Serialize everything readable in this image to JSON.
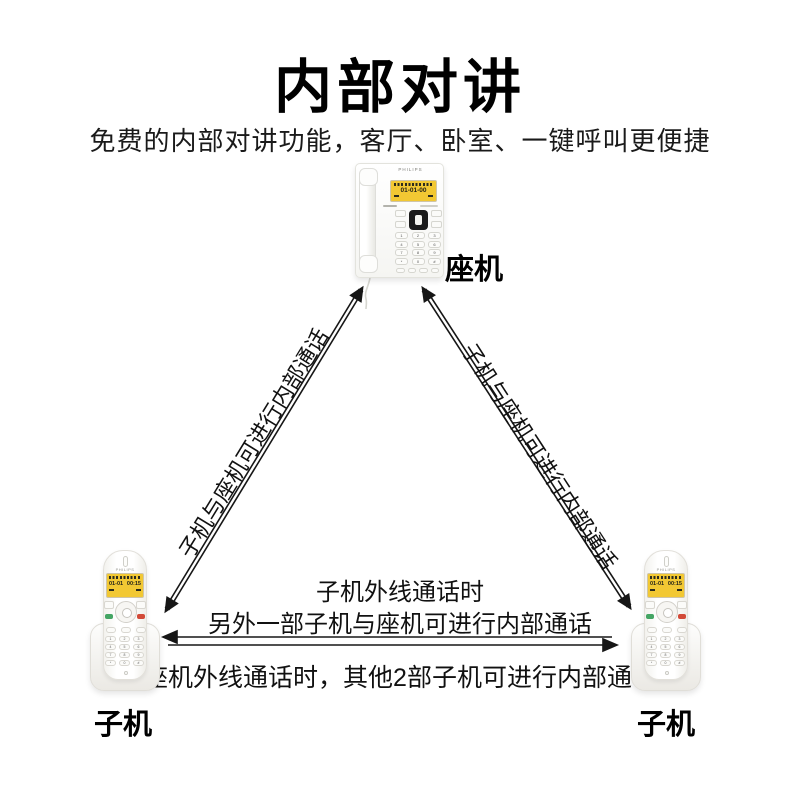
{
  "page": {
    "title": "内部对讲",
    "subtitle": "免费的内部对讲功能，客厅、卧室、一键呼叫更便捷"
  },
  "device_labels": {
    "base": "座机",
    "handset_left": "子机",
    "handset_right": "子机"
  },
  "connections": {
    "left_diagonal_label": "子机与座机可进行内部通话",
    "right_diagonal_label": "子机与座机可进行内部通话",
    "handset_busy_line1": "子机外线通话时",
    "handset_busy_line2": "另外一部子机与座机可进行内部通话",
    "base_busy_line": "座机外线通话时，其他2部子机可进行内部通话"
  },
  "base_phone": {
    "brand": "PHILIPS",
    "display_text": "01-01-00",
    "keypad": [
      "1",
      "2",
      "3",
      "4",
      "5",
      "6",
      "7",
      "8",
      "9",
      "*",
      "0",
      "#"
    ]
  },
  "handset": {
    "brand": "PHILIPS",
    "display_date": "01-01",
    "display_time": "00:15",
    "keypad": [
      "1",
      "2",
      "3",
      "4",
      "5",
      "6",
      "7",
      "8",
      "9",
      "*",
      "0",
      "#"
    ]
  },
  "colors": {
    "screen_yellow": "#f2c833",
    "arrow": "#161616",
    "call_key_green": "#44a564",
    "end_key_red": "#d24a38"
  }
}
